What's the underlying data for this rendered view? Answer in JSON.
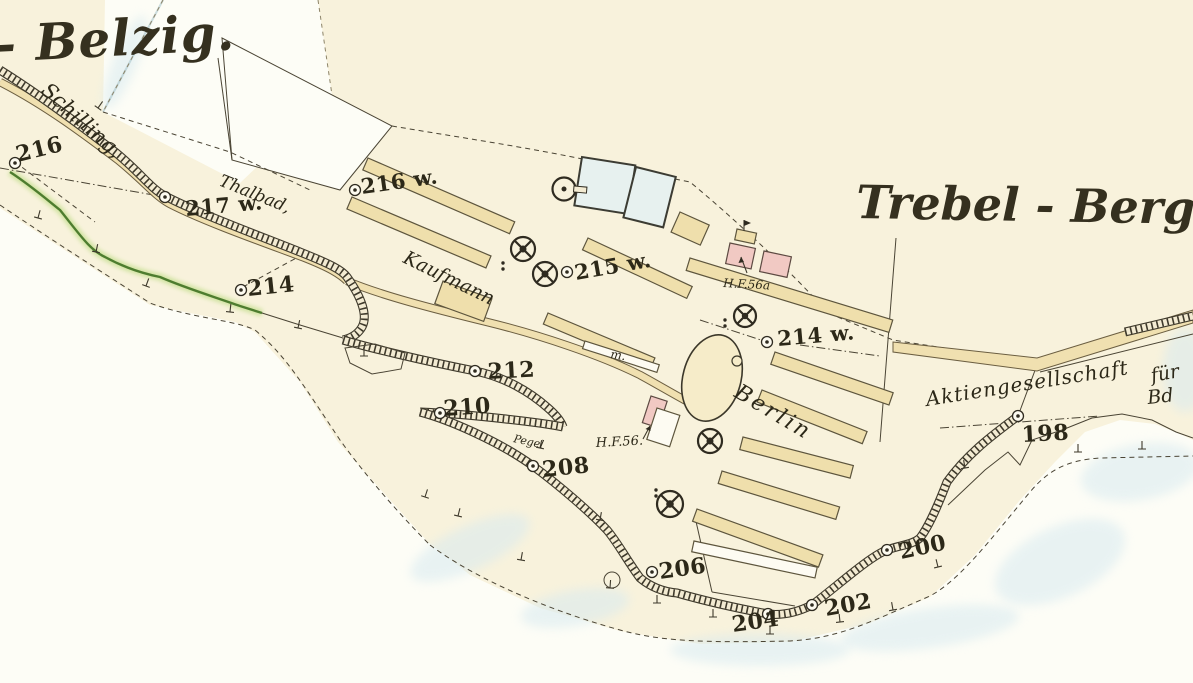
{
  "map": {
    "region_titles": {
      "left": "- Belzig.",
      "right": "Trebel - Berg"
    },
    "place_labels": {
      "schilling": "Schilling,",
      "thalbad": "Thalbad,",
      "kaufmann": "Kaufmann",
      "berlin": "Berlin",
      "aktiengesellschaft": "Aktiengesellschaft",
      "fuer": "für",
      "bd": "Bd",
      "pegel": "Pegel",
      "m": "m."
    },
    "parcel_labels": {
      "hf56a": "H.F.56a",
      "hf56": "H.F.56."
    },
    "elevation_markers": [
      "216",
      "217 w.",
      "214",
      "216 w.",
      "215 w.",
      "214 w.",
      "212",
      "210",
      "208",
      "206",
      "204",
      "202",
      "200",
      "198"
    ],
    "colors": {
      "paper": "#f8f2dc",
      "field_white": "#fdfdf6",
      "shed_tan": "#efdfac",
      "road_tan": "#f0e0b0",
      "kiln_pink": "#f1c9c3",
      "basin_blue": "#e7f1ef",
      "water_blue": "#d8eaf0",
      "vegetation_green": "#4e7d2f",
      "ink": "#3e392b"
    }
  }
}
